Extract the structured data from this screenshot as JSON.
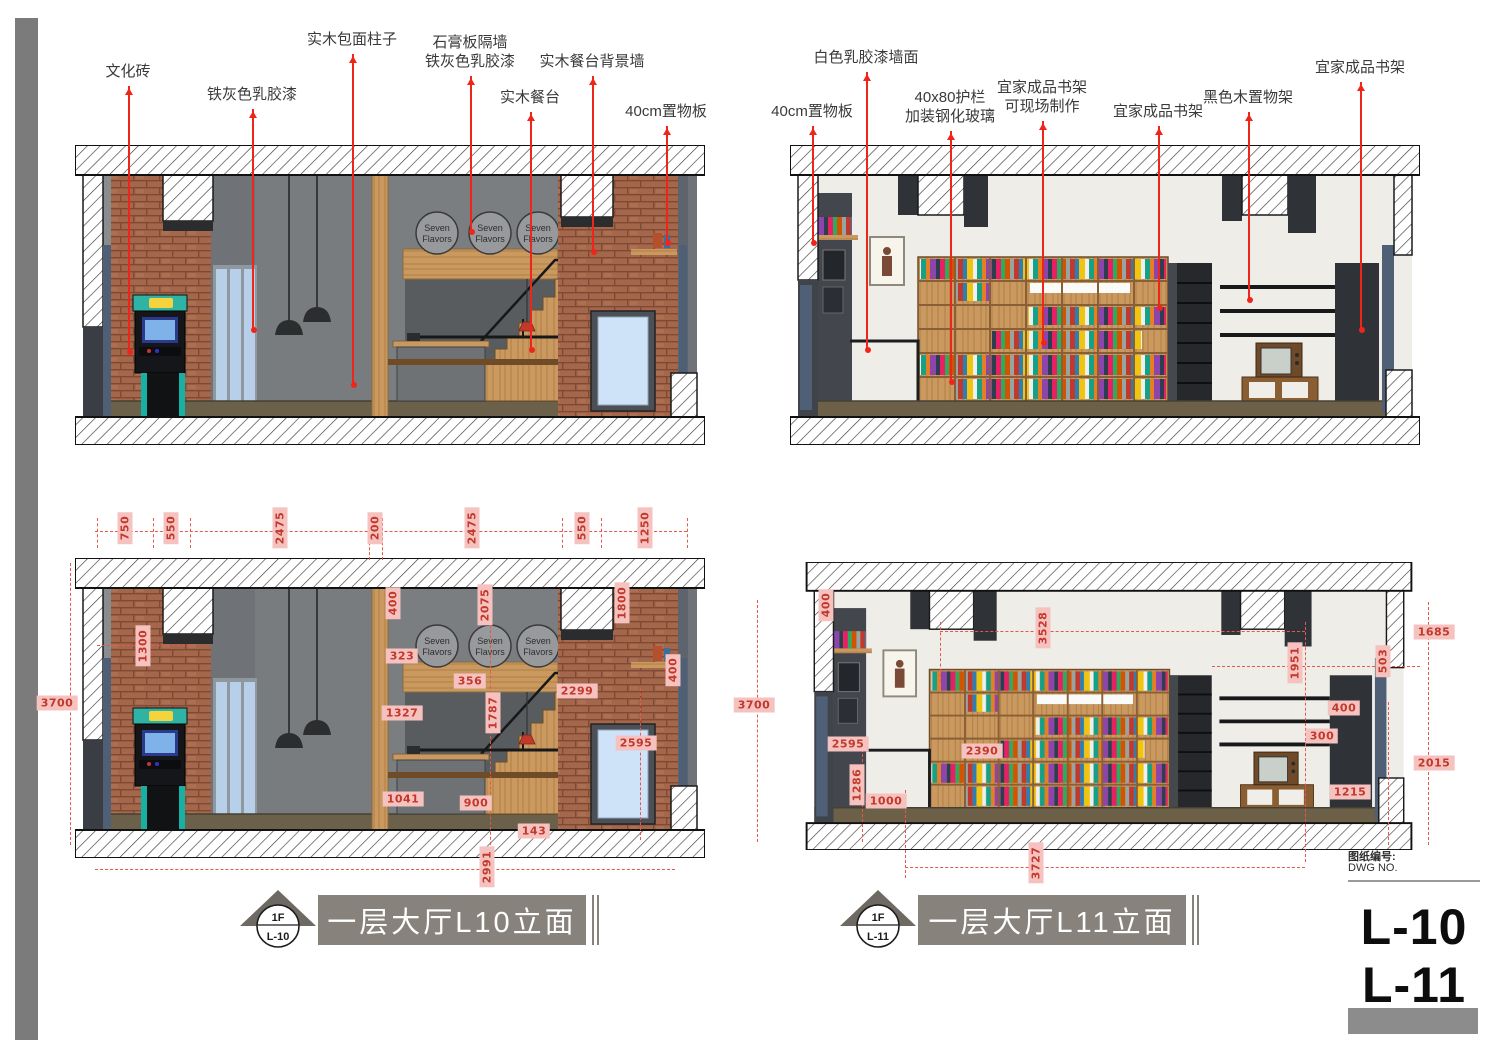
{
  "sheet": {
    "dwg_label": "图纸编号:",
    "dwg_no": "DWG NO.",
    "numbers": [
      "L-10",
      "L-11"
    ]
  },
  "titles": [
    {
      "floor": "1F",
      "code": "L-10",
      "text": "一层大厅L10立面"
    },
    {
      "floor": "1F",
      "code": "L-11",
      "text": "一层大厅L11立面"
    }
  ],
  "signs": {
    "line1": "Seven",
    "line2": "Flavors"
  },
  "colors": {
    "accent_red": "#f0251a",
    "dim_pink": "#f6c2c0",
    "dim_text": "#c0392b",
    "title_gray": "#87837c",
    "brick": "#a5674b",
    "wood": "#c9995f"
  },
  "annotations": {
    "labels": [
      {
        "t": [
          "文化砖"
        ],
        "x": 128,
        "y": 62,
        "e": 352
      },
      {
        "t": [
          "铁灰色乳胶漆"
        ],
        "x": 252,
        "y": 85,
        "e": 330
      },
      {
        "t": [
          "实木包面柱子"
        ],
        "x": 352,
        "y": 30,
        "e": 385
      },
      {
        "t": [
          "石膏板隔墙",
          "铁灰色乳胶漆"
        ],
        "x": 470,
        "y": 33,
        "e": 232
      },
      {
        "t": [
          "实木餐台"
        ],
        "x": 530,
        "y": 88,
        "e": 350
      },
      {
        "t": [
          "实木餐台背景墙"
        ],
        "x": 592,
        "y": 52,
        "e": 252
      },
      {
        "t": [
          "40cm置物板"
        ],
        "x": 666,
        "y": 102,
        "e": 243
      },
      {
        "t": [
          "40cm置物板"
        ],
        "x": 812,
        "y": 102,
        "e": 243
      },
      {
        "t": [
          "白色乳胶漆墙面"
        ],
        "x": 866,
        "y": 48,
        "e": 350
      },
      {
        "t": [
          "40x80护栏",
          "加装钢化玻璃"
        ],
        "x": 950,
        "y": 88,
        "e": 382
      },
      {
        "t": [
          "宜家成品书架",
          "可现场制作"
        ],
        "x": 1042,
        "y": 78,
        "e": 343
      },
      {
        "t": [
          "宜家成品书架"
        ],
        "x": 1158,
        "y": 102,
        "e": 308
      },
      {
        "t": [
          "黑色木置物架"
        ],
        "x": 1248,
        "y": 88,
        "e": 300
      },
      {
        "t": [
          "宜家成品书架"
        ],
        "x": 1360,
        "y": 58,
        "e": 330
      }
    ],
    "dims": [
      {
        "v": "750",
        "x": 125,
        "y": 528,
        "r": 1
      },
      {
        "v": "550",
        "x": 171,
        "y": 528,
        "r": 1
      },
      {
        "v": "2475",
        "x": 280,
        "y": 528,
        "r": 1
      },
      {
        "v": "200",
        "x": 375,
        "y": 528,
        "r": 1
      },
      {
        "v": "2475",
        "x": 472,
        "y": 528,
        "r": 1
      },
      {
        "v": "550",
        "x": 582,
        "y": 528,
        "r": 1
      },
      {
        "v": "1250",
        "x": 645,
        "y": 528,
        "r": 1
      },
      {
        "v": "3700",
        "x": 57,
        "y": 703,
        "r": 0
      },
      {
        "v": "1300",
        "x": 143,
        "y": 646,
        "r": 1
      },
      {
        "v": "400",
        "x": 393,
        "y": 603,
        "r": 1
      },
      {
        "v": "2075",
        "x": 485,
        "y": 605,
        "r": 1
      },
      {
        "v": "1800",
        "x": 622,
        "y": 603,
        "r": 1
      },
      {
        "v": "323",
        "x": 402,
        "y": 656,
        "r": 0
      },
      {
        "v": "356",
        "x": 470,
        "y": 681,
        "r": 0
      },
      {
        "v": "2299",
        "x": 577,
        "y": 691,
        "r": 0
      },
      {
        "v": "400",
        "x": 673,
        "y": 670,
        "r": 1
      },
      {
        "v": "1327",
        "x": 402,
        "y": 713,
        "r": 0
      },
      {
        "v": "1787",
        "x": 493,
        "y": 713,
        "r": 1
      },
      {
        "v": "2595",
        "x": 636,
        "y": 743,
        "r": 0
      },
      {
        "v": "1041",
        "x": 403,
        "y": 799,
        "r": 0
      },
      {
        "v": "900",
        "x": 476,
        "y": 803,
        "r": 0
      },
      {
        "v": "143",
        "x": 534,
        "y": 831,
        "r": 0
      },
      {
        "v": "2991",
        "x": 487,
        "y": 867,
        "r": 1
      },
      {
        "v": "3700",
        "x": 754,
        "y": 705,
        "r": 0
      },
      {
        "v": "400",
        "x": 826,
        "y": 605,
        "r": 1
      },
      {
        "v": "2595",
        "x": 848,
        "y": 744,
        "r": 0
      },
      {
        "v": "1286",
        "x": 857,
        "y": 785,
        "r": 1
      },
      {
        "v": "1000",
        "x": 886,
        "y": 801,
        "r": 0
      },
      {
        "v": "3528",
        "x": 1043,
        "y": 628,
        "r": 1
      },
      {
        "v": "2390",
        "x": 982,
        "y": 751,
        "r": 0
      },
      {
        "v": "3727",
        "x": 1036,
        "y": 863,
        "r": 1
      },
      {
        "v": "1951",
        "x": 1295,
        "y": 663,
        "r": 1
      },
      {
        "v": "503",
        "x": 1383,
        "y": 661,
        "r": 1
      },
      {
        "v": "1685",
        "x": 1434,
        "y": 632,
        "r": 0
      },
      {
        "v": "400",
        "x": 1344,
        "y": 708,
        "r": 0
      },
      {
        "v": "300",
        "x": 1322,
        "y": 736,
        "r": 0
      },
      {
        "v": "2015",
        "x": 1434,
        "y": 763,
        "r": 0
      },
      {
        "v": "1215",
        "x": 1350,
        "y": 792,
        "r": 0
      }
    ]
  }
}
